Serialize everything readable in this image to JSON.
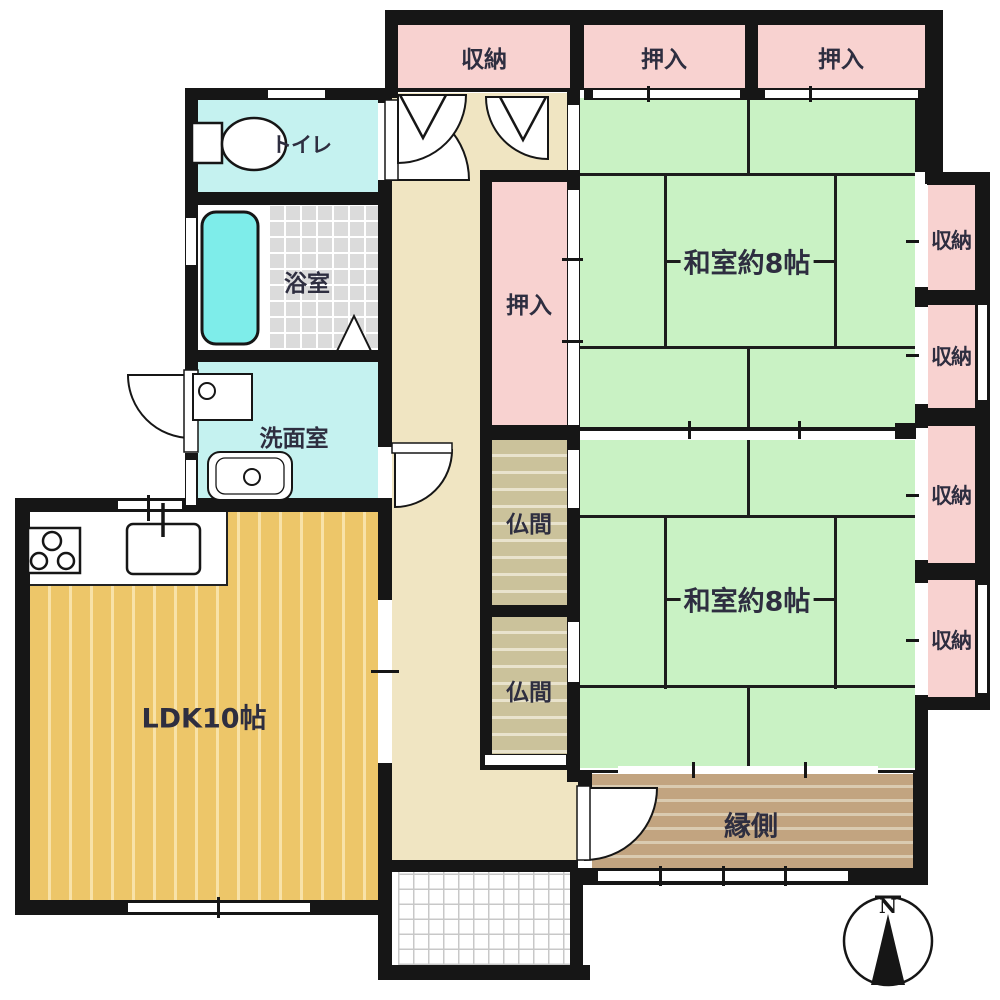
{
  "plan": {
    "compass_label": "N",
    "rooms": {
      "storage_top": "収納",
      "oshiire_top_left": "押入",
      "oshiire_top_right": "押入",
      "toilet": "トイレ",
      "bath": "浴室",
      "washroom": "洗面室",
      "oshiire_center": "押入",
      "butsuma_upper": "仏間",
      "butsuma_lower": "仏間",
      "washitsu_upper": "和室約8帖",
      "washitsu_lower": "和室約8帖",
      "storage_right_1": "収納",
      "storage_right_2": "収納",
      "storage_right_3": "収納",
      "storage_right_4": "収納",
      "ldk": "LDK10帖",
      "engawa": "縁側"
    },
    "colors": {
      "wall": "#161616",
      "tatami_green": "#C9F2C4",
      "closet_pink": "#F8D2D0",
      "wet_room_cyan": "#C5F2F0",
      "bathtub_cyan": "#7EEDEA",
      "hallway_beige": "#F0E5C2",
      "wood_floor": "#EDC669",
      "butsuma_khaki": "#CBC29B",
      "engawa_brown": "#C2A480",
      "label_text": "#2E2E40"
    }
  }
}
